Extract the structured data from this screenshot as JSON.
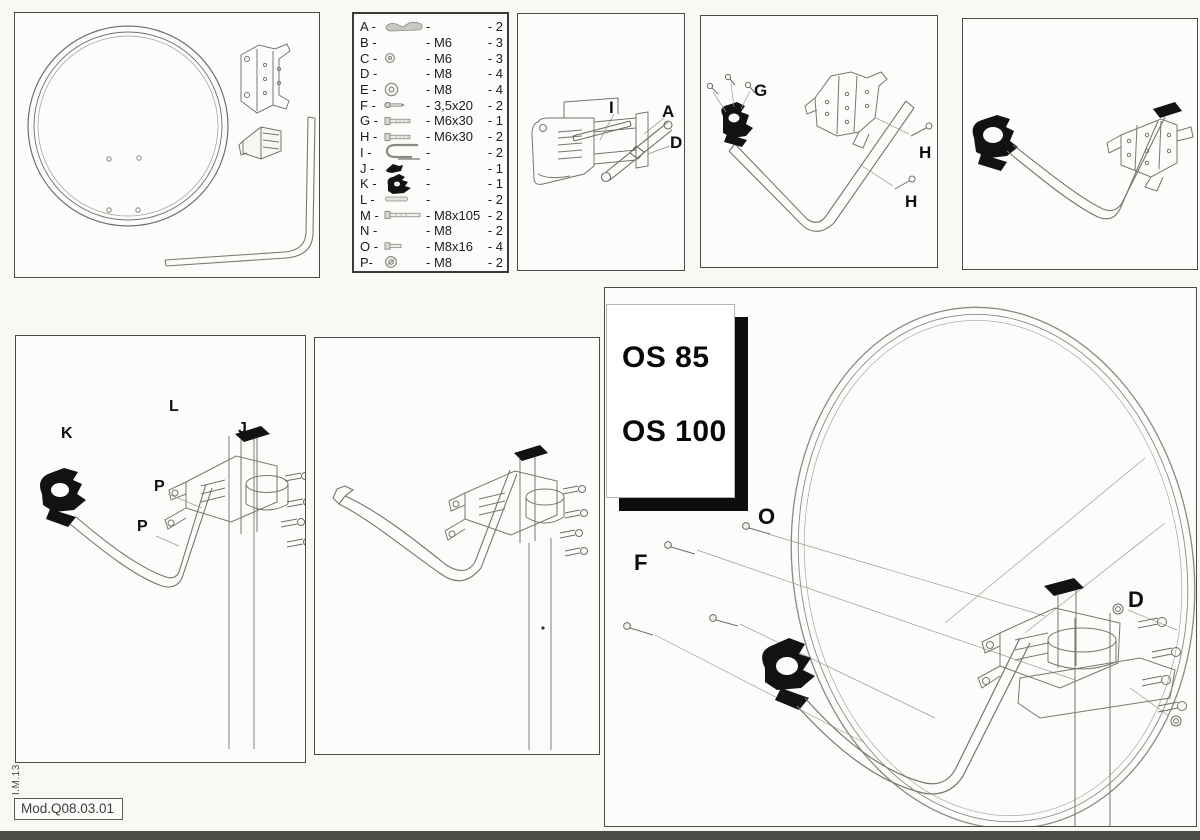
{
  "page": {
    "imprint": "I.M.13",
    "mod_label": "Mod.Q08.03.01"
  },
  "models": {
    "line1": "OS 85",
    "line2": "OS 100"
  },
  "parts_list": {
    "rows": [
      {
        "letter": "A -",
        "icon": "clamp-plate",
        "size": "-",
        "qty": "- 2"
      },
      {
        "letter": "B -",
        "icon": "none",
        "size": "- M6",
        "qty": "- 3"
      },
      {
        "letter": "C -",
        "icon": "washer-s",
        "size": "- M6",
        "qty": "- 3"
      },
      {
        "letter": "D -",
        "icon": "none",
        "size": "- M8",
        "qty": "- 4"
      },
      {
        "letter": "E -",
        "icon": "washer-l",
        "size": "- M8",
        "qty": "- 4"
      },
      {
        "letter": "F -",
        "icon": "screw-s",
        "size": "- 3,5x20",
        "qty": "- 2"
      },
      {
        "letter": "G -",
        "icon": "bolt-m",
        "size": "- M6x30",
        "qty": "- 1"
      },
      {
        "letter": "H -",
        "icon": "bolt-m",
        "size": "- M6x30",
        "qty": "- 2"
      },
      {
        "letter": "I -",
        "icon": "u-bolt",
        "size": "-",
        "qty": "- 2"
      },
      {
        "letter": "J -",
        "icon": "black-cap",
        "size": "-",
        "qty": "- 1"
      },
      {
        "letter": "K -",
        "icon": "black-clamp",
        "size": "-",
        "qty": "- 1"
      },
      {
        "letter": "L -",
        "icon": "rod",
        "size": "-",
        "qty": "- 2"
      },
      {
        "letter": "M -",
        "icon": "bolt-l",
        "size": "- M8x105",
        "qty": "- 2"
      },
      {
        "letter": "N -",
        "icon": "none",
        "size": "- M8",
        "qty": "- 2"
      },
      {
        "letter": "O -",
        "icon": "bolt-s",
        "size": "- M8x16",
        "qty": "- 4"
      },
      {
        "letter": "P-",
        "icon": "lock-washer",
        "size": "- M8",
        "qty": "- 2"
      }
    ]
  },
  "labels": {
    "p3": {
      "i": "I",
      "a": "A",
      "d": "D"
    },
    "p4": {
      "g": "G",
      "h1": "H",
      "h2": "H"
    },
    "p6": {
      "k": "K",
      "l": "L",
      "j": "J",
      "p1": "P",
      "p2": "P"
    },
    "p8": {
      "f": "F",
      "o": "O",
      "d": "D"
    }
  }
}
